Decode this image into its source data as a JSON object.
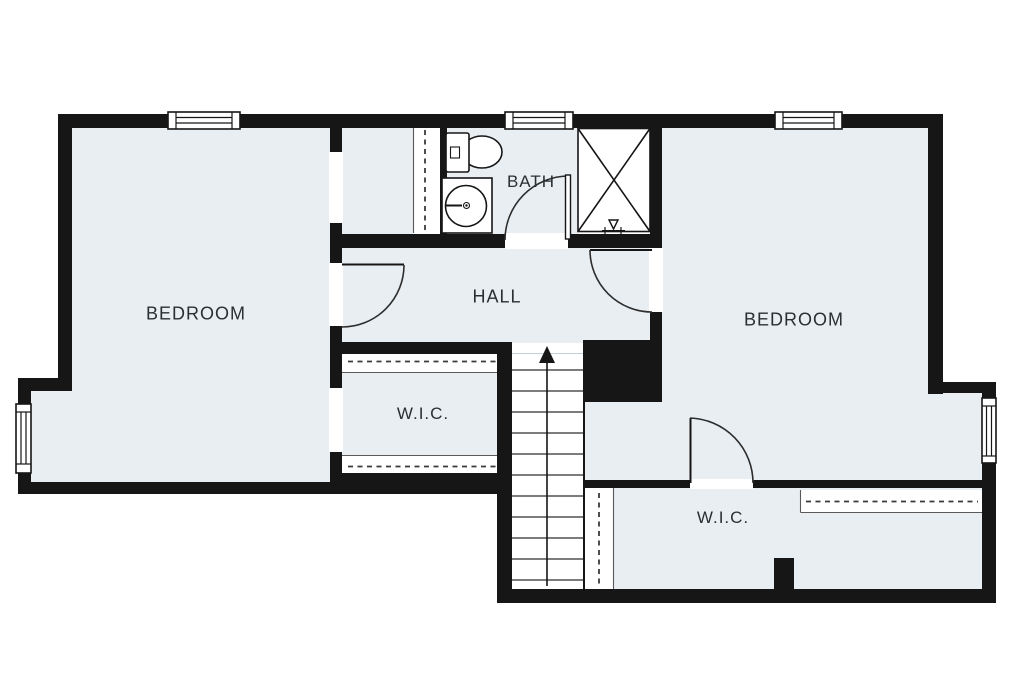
{
  "colors": {
    "background": "#ffffff",
    "floor_fill": "#e9eef2",
    "wall": "#161616",
    "line": "#2d2d2d",
    "text": "#2b2f33"
  },
  "rooms": {
    "bedroom_left": {
      "label": "BEDROOM"
    },
    "bath": {
      "label": "BATH"
    },
    "hall": {
      "label": "HALL"
    },
    "bedroom_right": {
      "label": "BEDROOM"
    },
    "wic_left": {
      "label": "W.I.C."
    },
    "wic_right": {
      "label": "W.I.C."
    }
  },
  "symbols": {
    "stairs_up_arrow": "solid triangle arrow with shaft on staircase",
    "shower_stall": "square stall crossed with X diagonals",
    "toilet": "tank-and-bowl toilet plan symbol",
    "sink": "vanity square with round basin and faucet",
    "closet_rod": "dashed line inside white strip = shelf with hanging rod",
    "door_swing": "quarter-circle swing arc with door leaf",
    "window": "white inset with parallel pane lines in wall"
  }
}
